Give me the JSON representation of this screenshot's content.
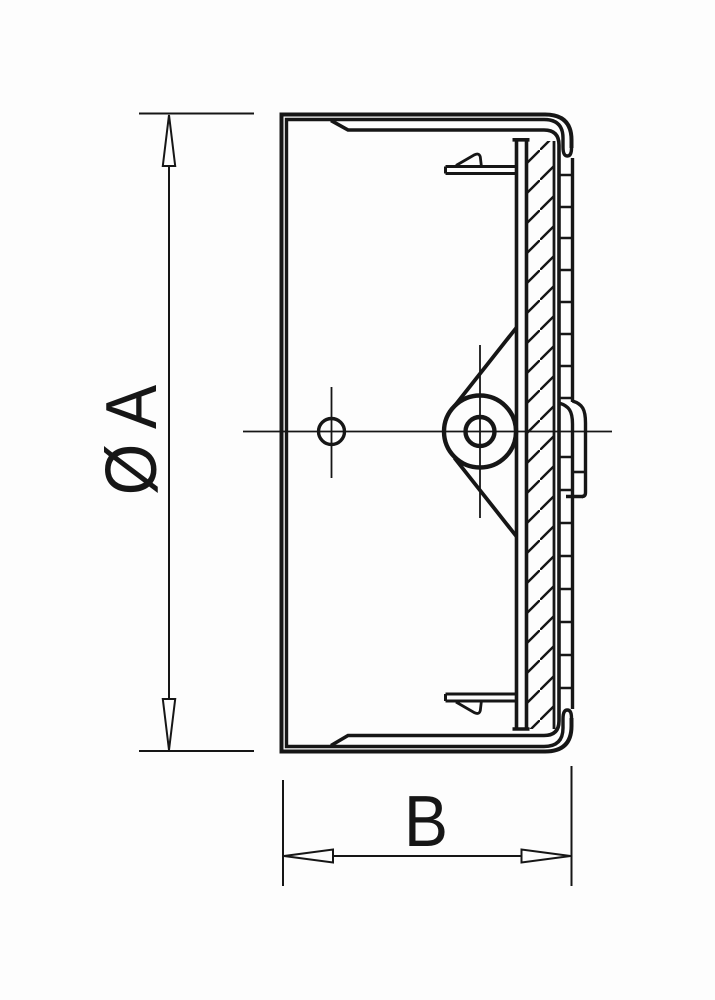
{
  "meta": {
    "type": "technical-drawing",
    "subject": "end-cap cross-section",
    "view": "sectional side view"
  },
  "colors": {
    "background": "#fdfdfd",
    "line": "#161616"
  },
  "dimensions": {
    "diameter": {
      "label": "Ø A",
      "orientation": "vertical"
    },
    "width": {
      "label": "B",
      "orientation": "horizontal"
    }
  }
}
